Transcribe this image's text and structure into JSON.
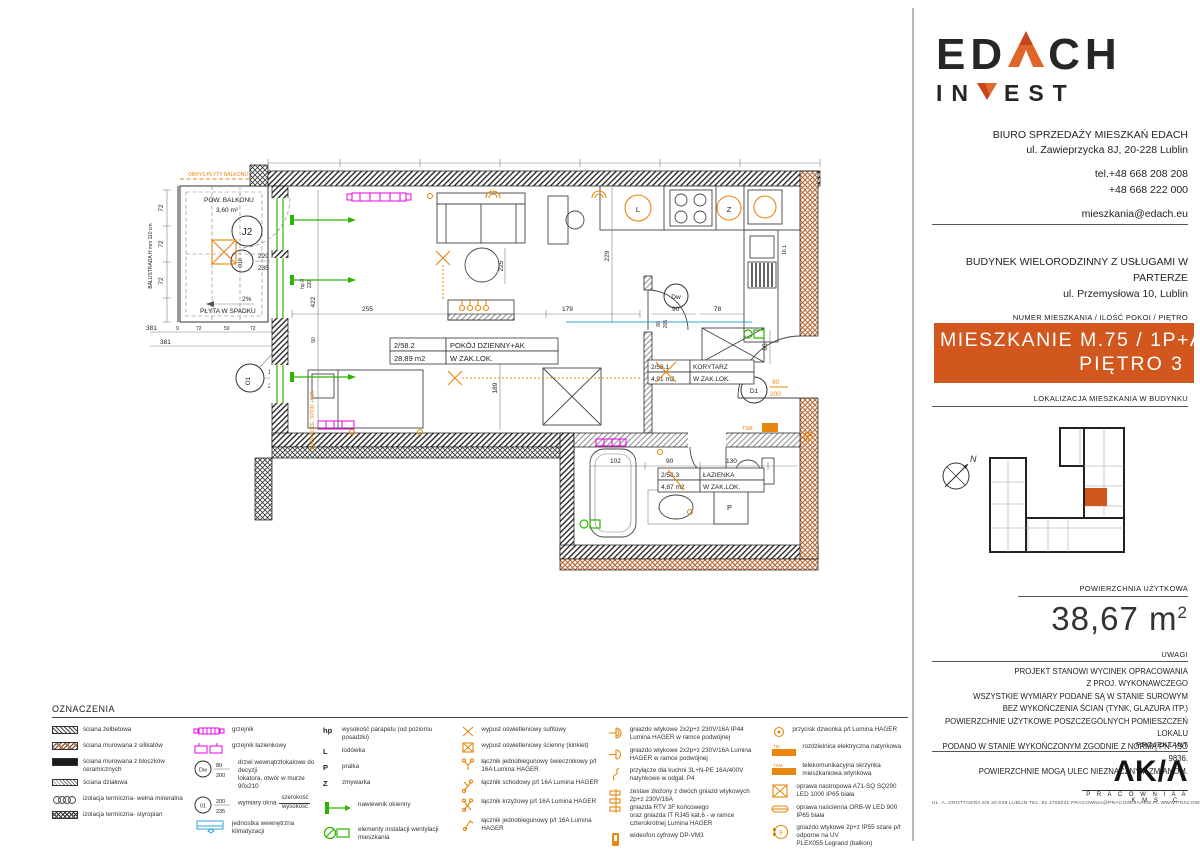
{
  "colors": {
    "accent_orange": "#D2571E",
    "symbol_orange": "#E8870F",
    "radiator_magenta": "#E800E8",
    "vent_green": "#2DB400",
    "ac_blue": "#2FA3DC"
  },
  "plan": {
    "balcony": {
      "outline": "OBRYS PŁYTY BALKONU",
      "label": "POW. BALKONU",
      "area": "3,60 m²",
      "tag": "J2",
      "window_tag": "O10",
      "window_w": "220",
      "window_h": "235",
      "slope_pct": "2%",
      "slope": "PŁYTA W SPADKU",
      "balustrade": "BALUSTRADA H mm 110 cm"
    },
    "rooms": [
      {
        "id": "2/58.2",
        "name": "POKÓJ DZIENNY+AK",
        "area": "28,89 m2",
        "note": "W ZAK.LOK."
      },
      {
        "id": "2/58.1",
        "name": "KORYTARZ",
        "area": "4,91 m2",
        "note": "W ZAK.LOK."
      },
      {
        "id": "2/58.3",
        "name": "ŁAZIENKA",
        "area": "4,87 m2",
        "note": "W ZAK.LOK."
      }
    ],
    "windows": {
      "o1": "O1",
      "o1_w": "100",
      "o1_h": "210"
    },
    "doors": {
      "d1": "D1",
      "d1_w": "90",
      "d1_h": "200",
      "dw": "Dw"
    },
    "appliances": {
      "fridge": "L",
      "dishwasher": "Z",
      "washer": "P"
    },
    "annotations": {
      "hp": "hp 0",
      "hp_h": "220",
      "nadproze": "NADPROŻE, SPÓD +8,35",
      "tsm": "TSM",
      "shaft": "16.1"
    },
    "dims": {
      "d255": "255",
      "d179": "179",
      "d422": "422",
      "d50": "50",
      "d225": "225",
      "d189": "189",
      "d229": "229",
      "d80": "80",
      "d205": "205",
      "d90": "90",
      "d78": "78",
      "d65": "65",
      "d102": "102",
      "d90b": "90",
      "d130": "130",
      "d381a": "381",
      "d381b": "381",
      "d72a": "72",
      "d72b": "72",
      "d72c": "72",
      "d9a": "9",
      "d72d": "72",
      "d50b": "50",
      "d72e": "72",
      "d9b": "9"
    }
  },
  "legend": {
    "title": "OZNACZENIA",
    "col1": [
      {
        "label": "ściana żelbetowa"
      },
      {
        "label": "ściana murowana z silikatów"
      },
      {
        "label": "ściana murowana z bloczków ceramicznych"
      },
      {
        "label": "ściana działowa"
      },
      {
        "label": "izolacja termiczna- wełna mineralna"
      },
      {
        "label": "izolacja termiczna- styropian"
      }
    ],
    "col2": [
      {
        "label": "grzejnik"
      },
      {
        "label": "grzejnik łazienkowy"
      },
      {
        "tag": "Dw",
        "top": "80",
        "bot": "200",
        "label": "drzwi wewnątrzlokalowe do decyzji\nlokatora, otwór w murze 90x210"
      },
      {
        "tag": "01",
        "top": "200",
        "bot": "235",
        "label": "wymiary okna",
        "frac_top": "szerokość",
        "frac_bot": "wysokość"
      },
      {
        "label": "jednostka wewnętrzna klimatyzacji"
      }
    ],
    "col3": [
      {
        "sym": "hp",
        "label": "wysokość parapetu (od poziomu posadzki)"
      },
      {
        "sym": "L",
        "label": "lodówka"
      },
      {
        "sym": "P",
        "label": "pralka"
      },
      {
        "sym": "Z",
        "label": "zmywarka"
      },
      {
        "label": "nawiewnik okienny"
      },
      {
        "label": "elementy instalacji wentylacji mieszkania"
      }
    ],
    "col4": [
      {
        "label": "wypust oświetleniowy sufitowy"
      },
      {
        "label": "wypust oświetleniowy ścienny (kinkiet)"
      },
      {
        "label": "łącznik jednobiegunowy świecznikowy  p/t 16A Lumina HAGER"
      },
      {
        "label": "łącznik schodowy  p/t 16A Lumina HAGER"
      },
      {
        "label": "łącznik krzyżowy  p/t 16A Lumina HAGER"
      },
      {
        "label": "łącznik jednobiegunowy p/t 16A Lumina HAGER"
      }
    ],
    "col5": [
      {
        "label": "gniazdo wtykowe 2x2p+z 230V/16A IP44 Lumina HAGER w ramce podwójnej"
      },
      {
        "label": "gniazdo wtykowe 2x2p+z 230V/16A Lumina HAGER w ramce podwójnej"
      },
      {
        "label": "przyłącze dla kuchni 3L+N-PE 16A/400V natynkowe w odgał. P4"
      },
      {
        "label": "zestaw złożony z dwóch gniazd wtykowych 2p+z 230V/16A\ngniazda RTV 3F końcowego\noraz gniazda IT RJ45 kat.6 - w ramce czterokrotnej Lumina HAGER"
      },
      {
        "label": "wideofon cyfrowy DP-VM3"
      }
    ],
    "col6": [
      {
        "label": "przycisk dzwonka p/t Lumina HAGER"
      },
      {
        "tag": "TM",
        "label": "rozdzielnica elektryczna natynkowa"
      },
      {
        "tag": "TSM",
        "label": "telekomunikacyjna skrzynka mieszkaniowa wtynkowa"
      },
      {
        "label": "oprawa nastropowa A71-SQ SQ290 LED 1000 IP65 biała"
      },
      {
        "label": "oprawa naścienna ORB-W LED 900 IP65 biała"
      },
      {
        "label": "gniazdo wtykowe 2p+z IP55 szare p/t odporne na UV\nPLEX055 Legrand (balkon)"
      }
    ]
  },
  "sidebar": {
    "logo": {
      "p1": "ED",
      "p2": "CH",
      "p3": "IN",
      "p4": "EST"
    },
    "office": {
      "line1": "BIURO SPRZEDAŻY MIESZKAŃ EDACH",
      "line2": "ul. Zawieprzycka 8J, 20-228 Lublin",
      "phone1": "tel.+48 668 208 208",
      "phone2": "+48 668 222 000",
      "email": "mieszkania@edach.eu"
    },
    "building": {
      "line1": "BUDYNEK WIELORODZINNY Z USŁUGAMI W PARTERZE",
      "line2": "ul. Przemysłowa 10, Lublin"
    },
    "apartment": {
      "caption": "NUMER MIESZKANIA / ILOŚĆ POKOI / PIĘTRO",
      "line1": "MIESZKANIE M.75 / 1P+AK",
      "line2": "PIĘTRO 3"
    },
    "location_caption": "LOKALIZACJA MIESZKANIA W BUDYNKU",
    "map_north": "N",
    "area": {
      "caption": "POWIERZCHNIA UŻYTKOWA",
      "value": "38,67 m",
      "sup": "2"
    },
    "notes": {
      "caption": "UWAGI",
      "lines": [
        "PROJEKT STANOWI WYCINEK OPRACOWANIA",
        "Z PROJ. WYKONAWCZEGO",
        "WSZYSTKIE WYMIARY PODANE SĄ W STANIE SUROWYM",
        "BEZ WYKOŃCZENIA ŚCIAN (TYNK, GLAZURA ITP.)",
        "POWIERZCHNIE UŻYTKOWE POSZCZEGÓLNYCH POMIESZCZEŃ LOKALU",
        "PODANO W STANIE WYKOŃCZONYM ZGODNIE Z NORMĄ PN- ISO 9836.",
        "POWIERZCHNIE MOGĄ ULEC NIEZNACZNYM ZMIANOM."
      ]
    },
    "designer": {
      "caption": "PROJEKTANT",
      "logo": "ΛK/Λ",
      "name": "P R A C O W N I A   A K M   S . C .",
      "footer": "UL. A. GROTTGERA 5/9   20-029 LUBLIN   TEL. 81 4795031   PRACOWNIA@PRACOWNIAAKM.PL   WWW.PRACOWNIAAKM.PL"
    }
  }
}
